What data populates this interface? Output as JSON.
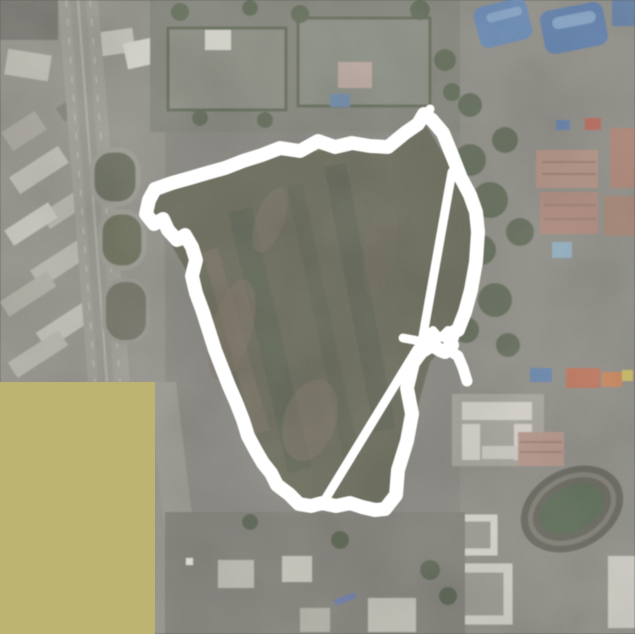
{
  "map": {
    "kind": "satellite-aerial-view",
    "colors": {
      "track": "#ffffff",
      "mask_overlay": "#bdb472",
      "park": "#50503f",
      "urban_base": "#76746f",
      "highway": "#8f8d86",
      "blue_roof": "#41699f",
      "red_buildings": "#a37a6c",
      "white_buildings": "#d0cdc5",
      "stadium_green": "#3c5037"
    },
    "mask_rect": {
      "x": 0,
      "y": 382,
      "width": 155,
      "height": 252
    },
    "gps_track": {
      "color": "#ffffff",
      "loop_width": 14,
      "loop": [
        [
          445,
          352
        ],
        [
          452,
          345
        ],
        [
          448,
          335
        ],
        [
          458,
          330
        ],
        [
          465,
          312
        ],
        [
          471,
          290
        ],
        [
          476,
          262
        ],
        [
          478,
          232
        ],
        [
          476,
          212
        ],
        [
          470,
          195
        ],
        [
          461,
          178
        ],
        [
          452,
          155
        ],
        [
          443,
          133
        ],
        [
          432,
          120
        ],
        [
          424,
          114
        ],
        [
          418,
          124
        ],
        [
          405,
          133
        ],
        [
          388,
          147
        ],
        [
          370,
          146
        ],
        [
          352,
          143
        ],
        [
          335,
          147
        ],
        [
          318,
          141
        ],
        [
          300,
          151
        ],
        [
          280,
          148
        ],
        [
          262,
          155
        ],
        [
          243,
          161
        ],
        [
          225,
          168
        ],
        [
          207,
          173
        ],
        [
          190,
          178
        ],
        [
          172,
          183
        ],
        [
          155,
          189
        ],
        [
          149,
          200
        ],
        [
          146,
          214
        ],
        [
          154,
          224
        ],
        [
          163,
          219
        ],
        [
          168,
          230
        ],
        [
          177,
          240
        ],
        [
          185,
          235
        ],
        [
          192,
          247
        ],
        [
          196,
          260
        ],
        [
          192,
          276
        ],
        [
          196,
          293
        ],
        [
          203,
          312
        ],
        [
          209,
          331
        ],
        [
          215,
          350
        ],
        [
          222,
          368
        ],
        [
          229,
          386
        ],
        [
          236,
          402
        ],
        [
          243,
          420
        ],
        [
          248,
          436
        ],
        [
          256,
          451
        ],
        [
          263,
          463
        ],
        [
          271,
          473
        ],
        [
          277,
          485
        ],
        [
          289,
          494
        ],
        [
          299,
          504
        ],
        [
          311,
          506
        ],
        [
          322,
          503
        ],
        [
          336,
          506
        ],
        [
          350,
          503
        ],
        [
          362,
          507
        ],
        [
          375,
          510
        ],
        [
          385,
          509
        ],
        [
          396,
          495
        ],
        [
          398,
          470
        ],
        [
          407,
          441
        ],
        [
          412,
          414
        ],
        [
          407,
          388
        ],
        [
          413,
          363
        ],
        [
          421,
          352
        ],
        [
          432,
          345
        ],
        [
          440,
          350
        ],
        [
          445,
          352
        ]
      ],
      "segments": [
        {
          "name": "chord-long",
          "width": 9,
          "points": [
            [
              417,
              349
            ],
            [
              323,
              503
            ]
          ]
        },
        {
          "name": "chord-upper",
          "width": 9,
          "points": [
            [
              452,
              172
            ],
            [
              421,
              347
            ]
          ]
        },
        {
          "name": "spur-terminal",
          "width": 11,
          "points": [
            [
              447,
              349
            ],
            [
              458,
              356
            ],
            [
              463,
              368
            ],
            [
              467,
              381
            ]
          ]
        },
        {
          "name": "spur-arm",
          "width": 9,
          "points": [
            [
              430,
              344
            ],
            [
              414,
              340
            ],
            [
              403,
              338
            ]
          ]
        },
        {
          "name": "peak-notch",
          "width": 9,
          "points": [
            [
              425,
              120
            ],
            [
              430,
              109
            ]
          ]
        },
        {
          "name": "junction-scribble",
          "width": 8,
          "points": [
            [
              425,
              337
            ],
            [
              433,
              330
            ],
            [
              440,
              338
            ],
            [
              448,
              330
            ],
            [
              455,
              338
            ],
            [
              449,
              345
            ]
          ]
        }
      ],
      "blobs": [
        {
          "cx": 432,
          "cy": 342,
          "r": 7
        },
        {
          "cx": 447,
          "cy": 338,
          "r": 6
        },
        {
          "cx": 443,
          "cy": 350,
          "r": 6
        },
        {
          "cx": 158,
          "cy": 222,
          "r": 5
        },
        {
          "cx": 180,
          "cy": 240,
          "r": 6
        }
      ]
    }
  }
}
